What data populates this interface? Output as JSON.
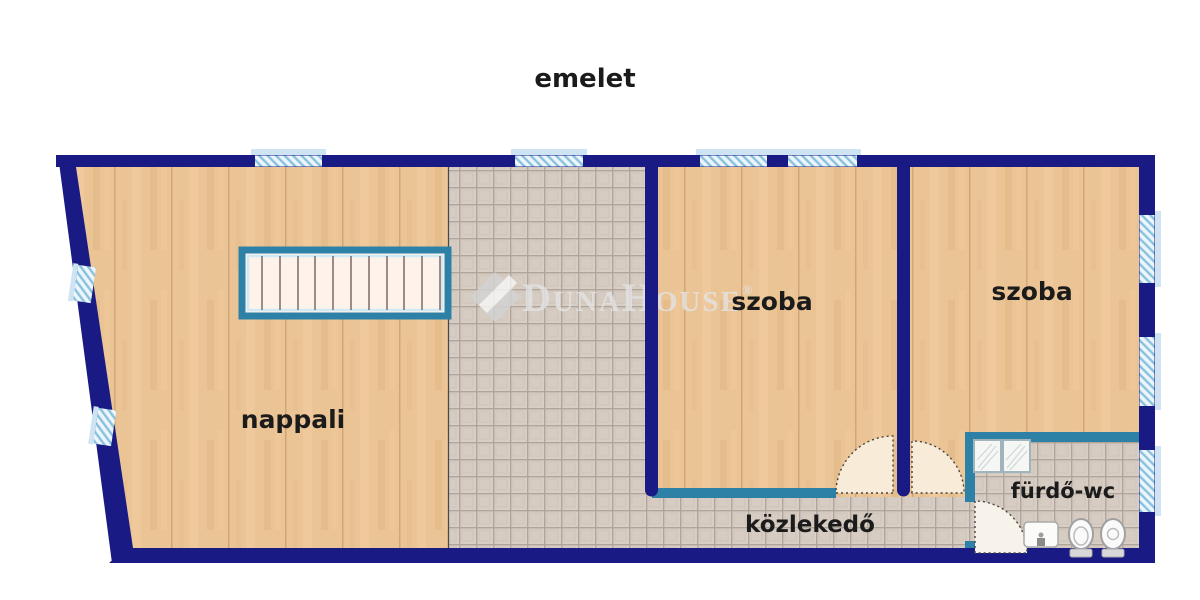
{
  "title": "emelet",
  "labels": {
    "living_room": "nappali",
    "room1": "szoba",
    "room2": "szoba",
    "hallway": "közlekedő",
    "bathroom": "fürdő-wc"
  },
  "watermark": {
    "part1": "D",
    "part2": "UNA",
    "part3": "H",
    "part4": "OUSE",
    "registered": "®"
  },
  "colors": {
    "wall": "#1a1a84",
    "partition_wall": "#2e81a6",
    "wood_floor": "#eac494",
    "tile_floor": "#d7cec5",
    "window_hatch": "#8ac2de",
    "window_sill": "#cfe4f3",
    "door_swing": "#f8ecd9",
    "background": "#ffffff"
  }
}
